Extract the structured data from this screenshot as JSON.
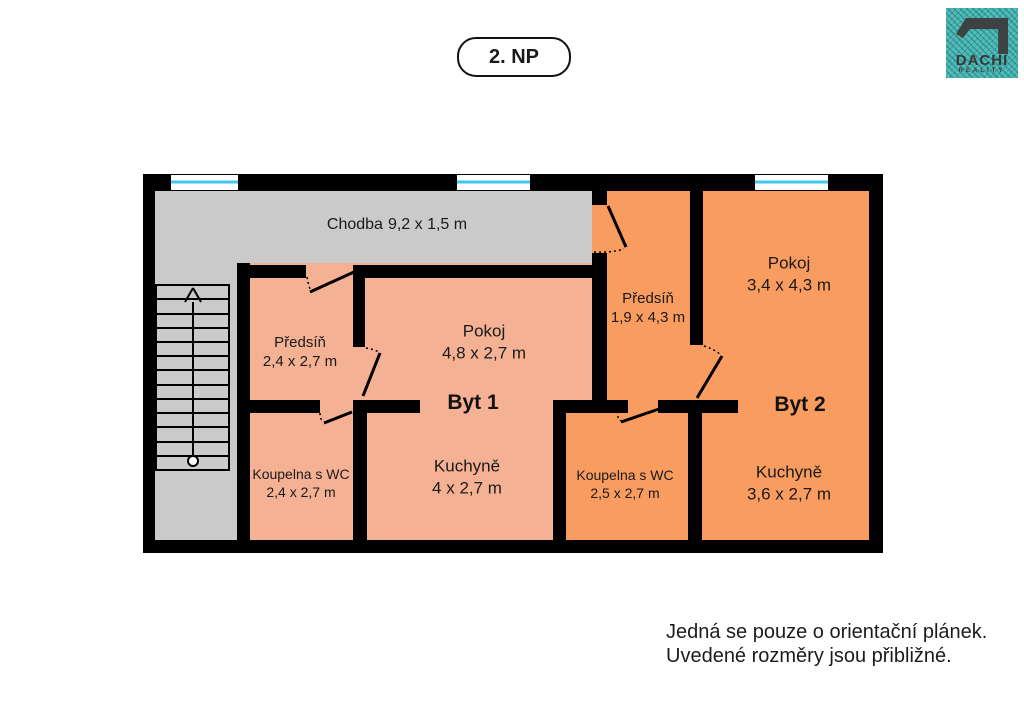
{
  "title_badge": {
    "label": "2. NP"
  },
  "logo": {
    "brand": "DACHI",
    "subtext": "REALITY"
  },
  "colors": {
    "wall": "#000000",
    "corridor": "#CACACA",
    "byt1": "#F5B193",
    "byt2": "#F89C60",
    "window": "#3FC6F0",
    "logo_teal": "#4DBFBC",
    "logo_dark": "#3E4242"
  },
  "rooms": {
    "chodba": {
      "name": "Chodba",
      "dims": "9,2 x 1,5 m"
    },
    "byt1_predsin": {
      "name": "Předsíň",
      "dims": "2,4 x 2,7 m"
    },
    "byt1_pokoj": {
      "name": "Pokoj",
      "dims": "4,8 x 2,7 m"
    },
    "byt1_kuchyne": {
      "name": "Kuchyně",
      "dims": "4 x 2,7 m"
    },
    "byt1_koupelna": {
      "name": "Koupelna s WC",
      "dims": "2,4 x 2,7 m"
    },
    "byt2_predsin": {
      "name": "Předsíň",
      "dims": "1,9 x 4,3 m"
    },
    "byt2_pokoj": {
      "name": "Pokoj",
      "dims": "3,4 x 4,3 m"
    },
    "byt2_kuchyne": {
      "name": "Kuchyně",
      "dims": "3,6 x 2,7 m"
    },
    "byt2_koupelna": {
      "name": "Koupelna s WC",
      "dims": "2,5 x 2,7 m"
    }
  },
  "apartment_labels": {
    "byt1": "Byt 1",
    "byt2": "Byt 2"
  },
  "disclaimer": {
    "line1": "Jedná se pouze o orientační plánek.",
    "line2": "Uvedené rozměry jsou přibližné."
  }
}
